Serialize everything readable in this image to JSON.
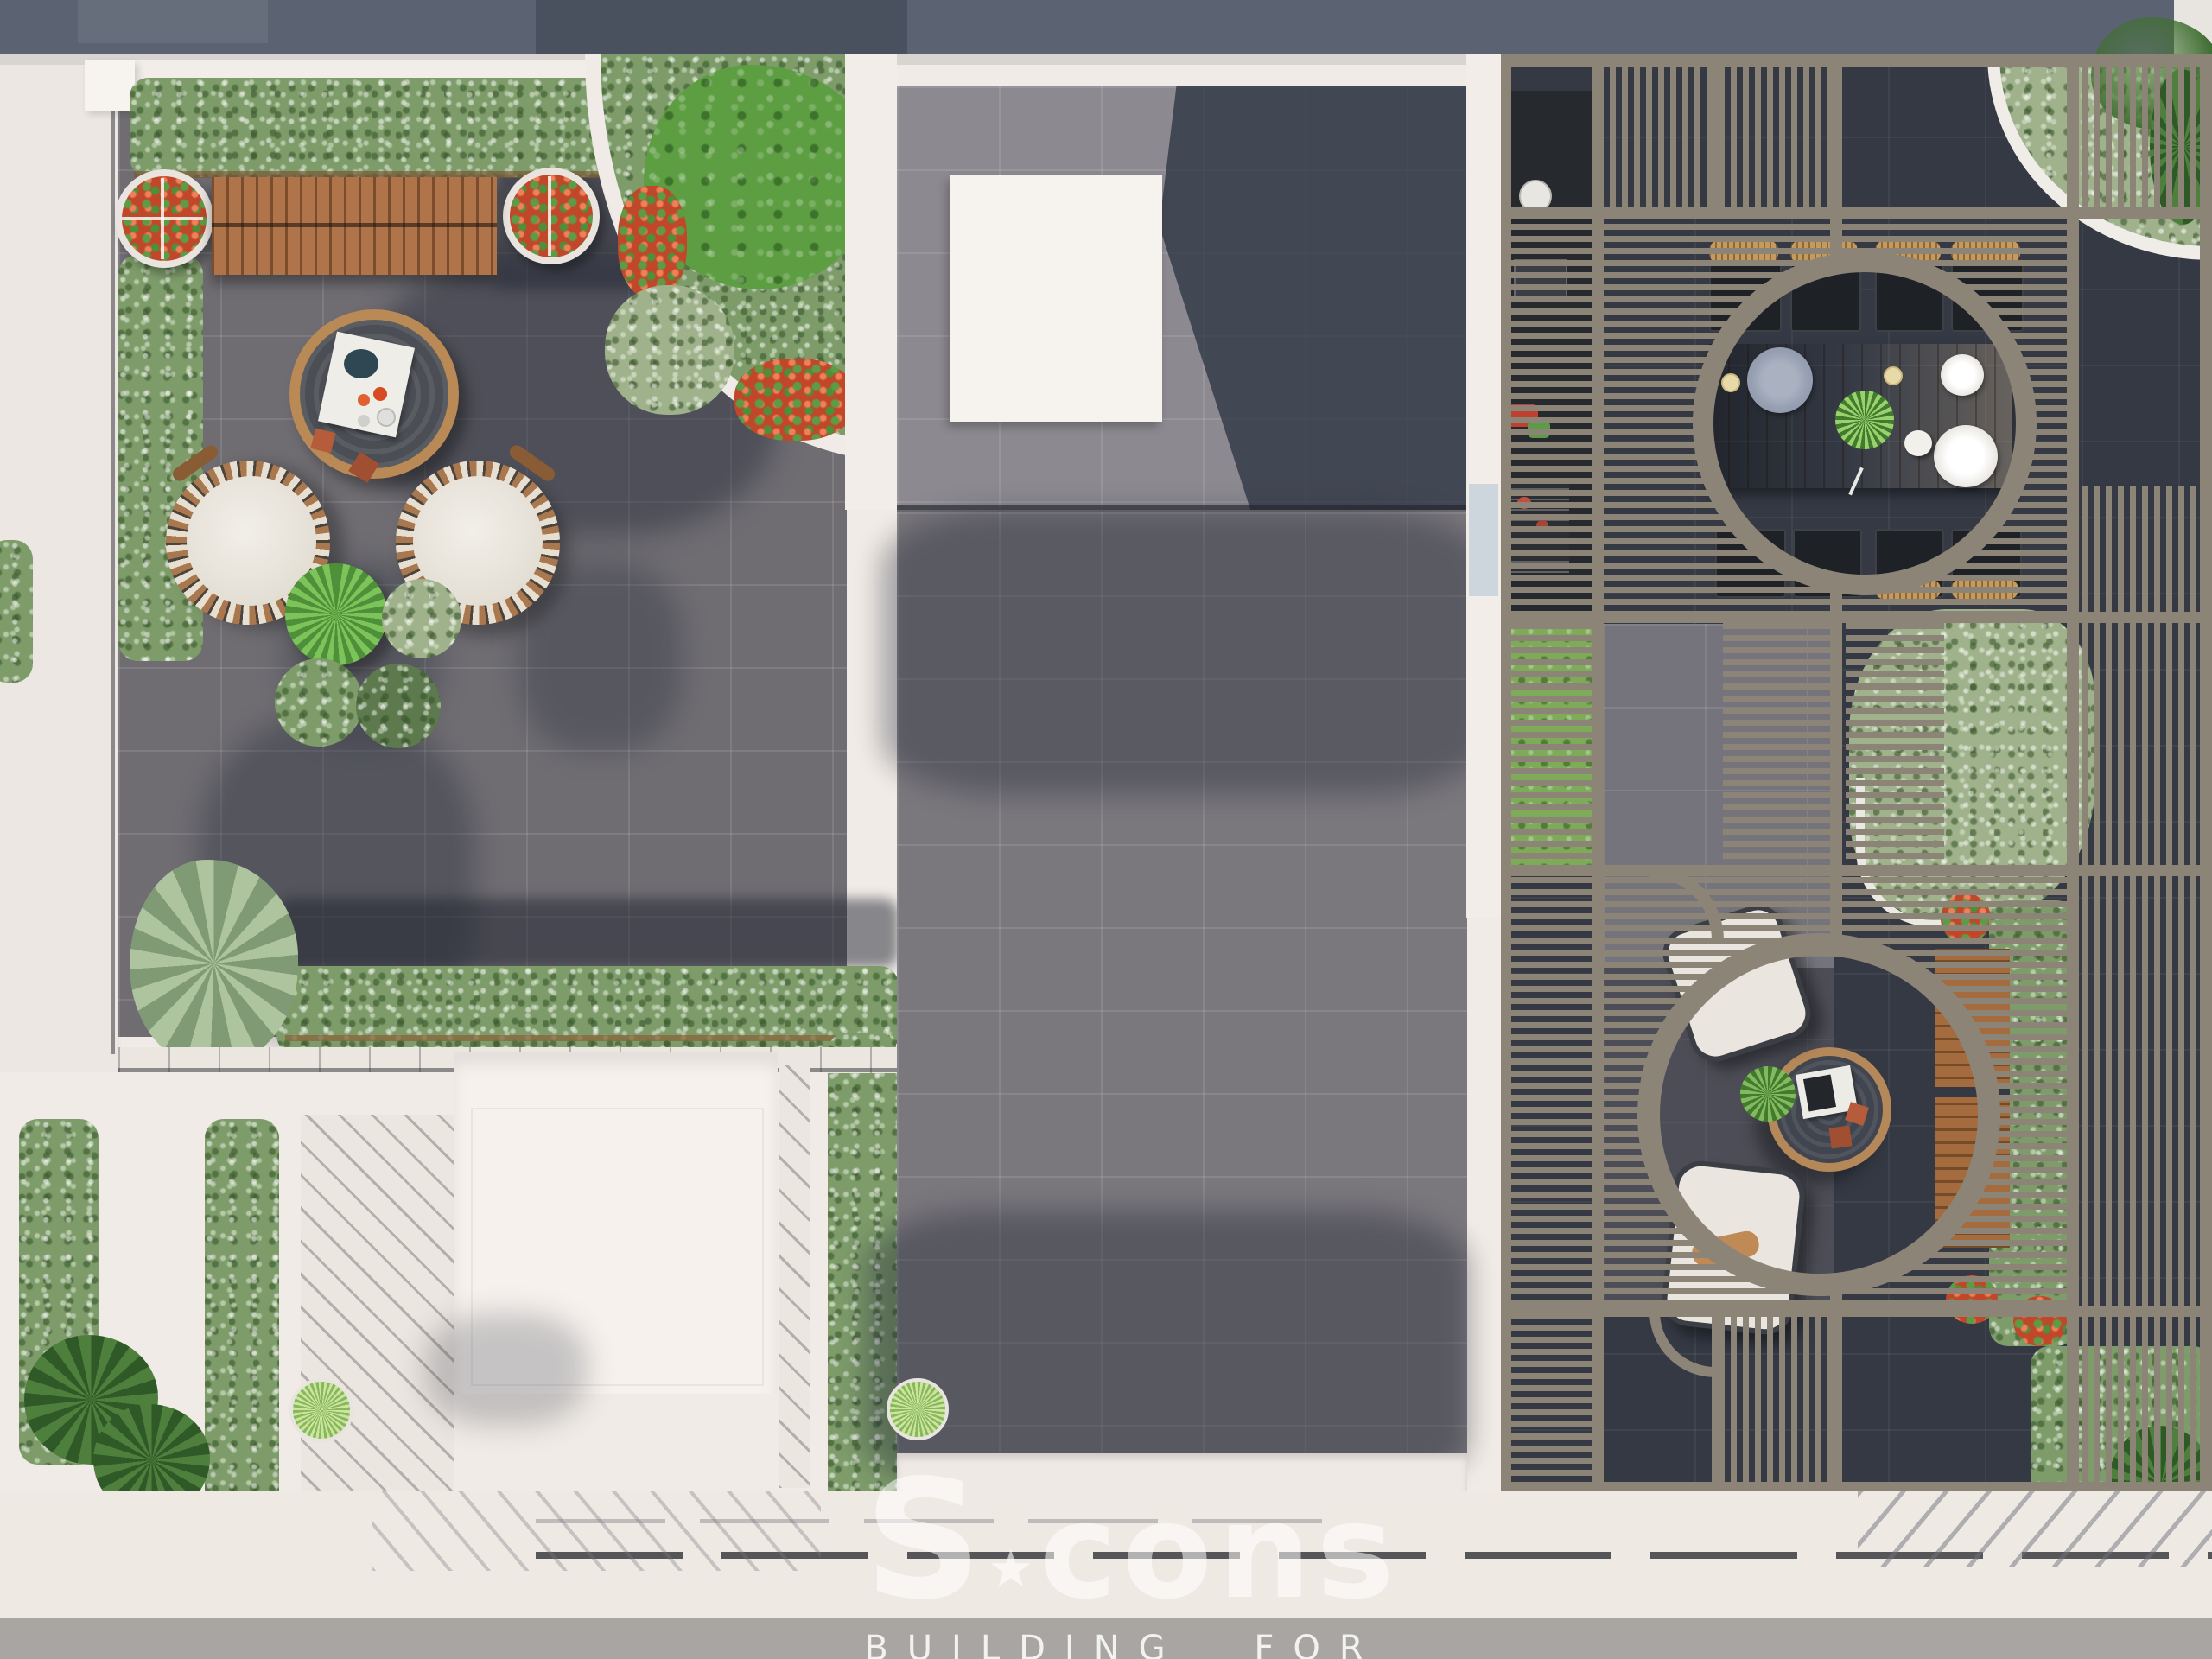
{
  "watermark": {
    "s": "S",
    "star": "★",
    "rest": "cons",
    "tagline": "BUILDING FOR LIFE"
  },
  "scene": {
    "type": "architectural_render_top_view",
    "subject": "rooftop terrace garden, orthographic top-down 3D visualization",
    "areas": [
      "left lounge terrace with gray pavers and hedge-lined parapets",
      "corner quarter-circle planter with large tree, white and red flowers",
      "central courtyard with raised paved platform and white skylight box",
      "right pergola grid of slatted shade panels with two circular openings",
      "pergola dining area: wood table, eight chairs, place settings",
      "pergola tea lounge: round table, two armchairs, wood bench",
      "outdoor kitchen counter strip with grill and plates",
      "lower white service terrace with deck boards, hedges and potted plants",
      "perimeter white walkway and street band at bottom"
    ],
    "furniture": [
      "wooden slat bench",
      "round flower planter x2",
      "round coffee table with tray",
      "woven egg lounge chair x2",
      "fan palm pot",
      "flowering pot",
      "shrub pot x2",
      "dining table with 8 chairs (rattan tops)",
      "round tea table with tray",
      "outdoor armchair x2",
      "vertical wood bench",
      "grass bowl planter",
      "schefflera floor plants",
      "grill",
      "plate stack"
    ]
  },
  "palette": {
    "top_band": "#5b6271",
    "parapet_white": "#f1ece8",
    "skylight_white": "#f6f2ee",
    "paving_platform": "#8c8a90",
    "paving_courtyard": "#7b787d",
    "paving_terrace": "#6f6d72",
    "paving_dark": "#343944",
    "shadow_blue": "#3d4454",
    "pergola_frame": "#8d8478",
    "wood_light": "#c9965e",
    "wood_mid": "#b0744a",
    "wood_dark": "#8a5c36",
    "hedge_green": "#7d9c6a",
    "hedge_pale": "#9fb28c",
    "tree_green": "#5d9e42",
    "grass_green": "#9cc768",
    "flower_red": "#c84b2d",
    "cushion_white": "#e9e4dc",
    "street_band": "#a9a5a2",
    "watermark_white": "rgba(255,255,255,0.55)"
  }
}
